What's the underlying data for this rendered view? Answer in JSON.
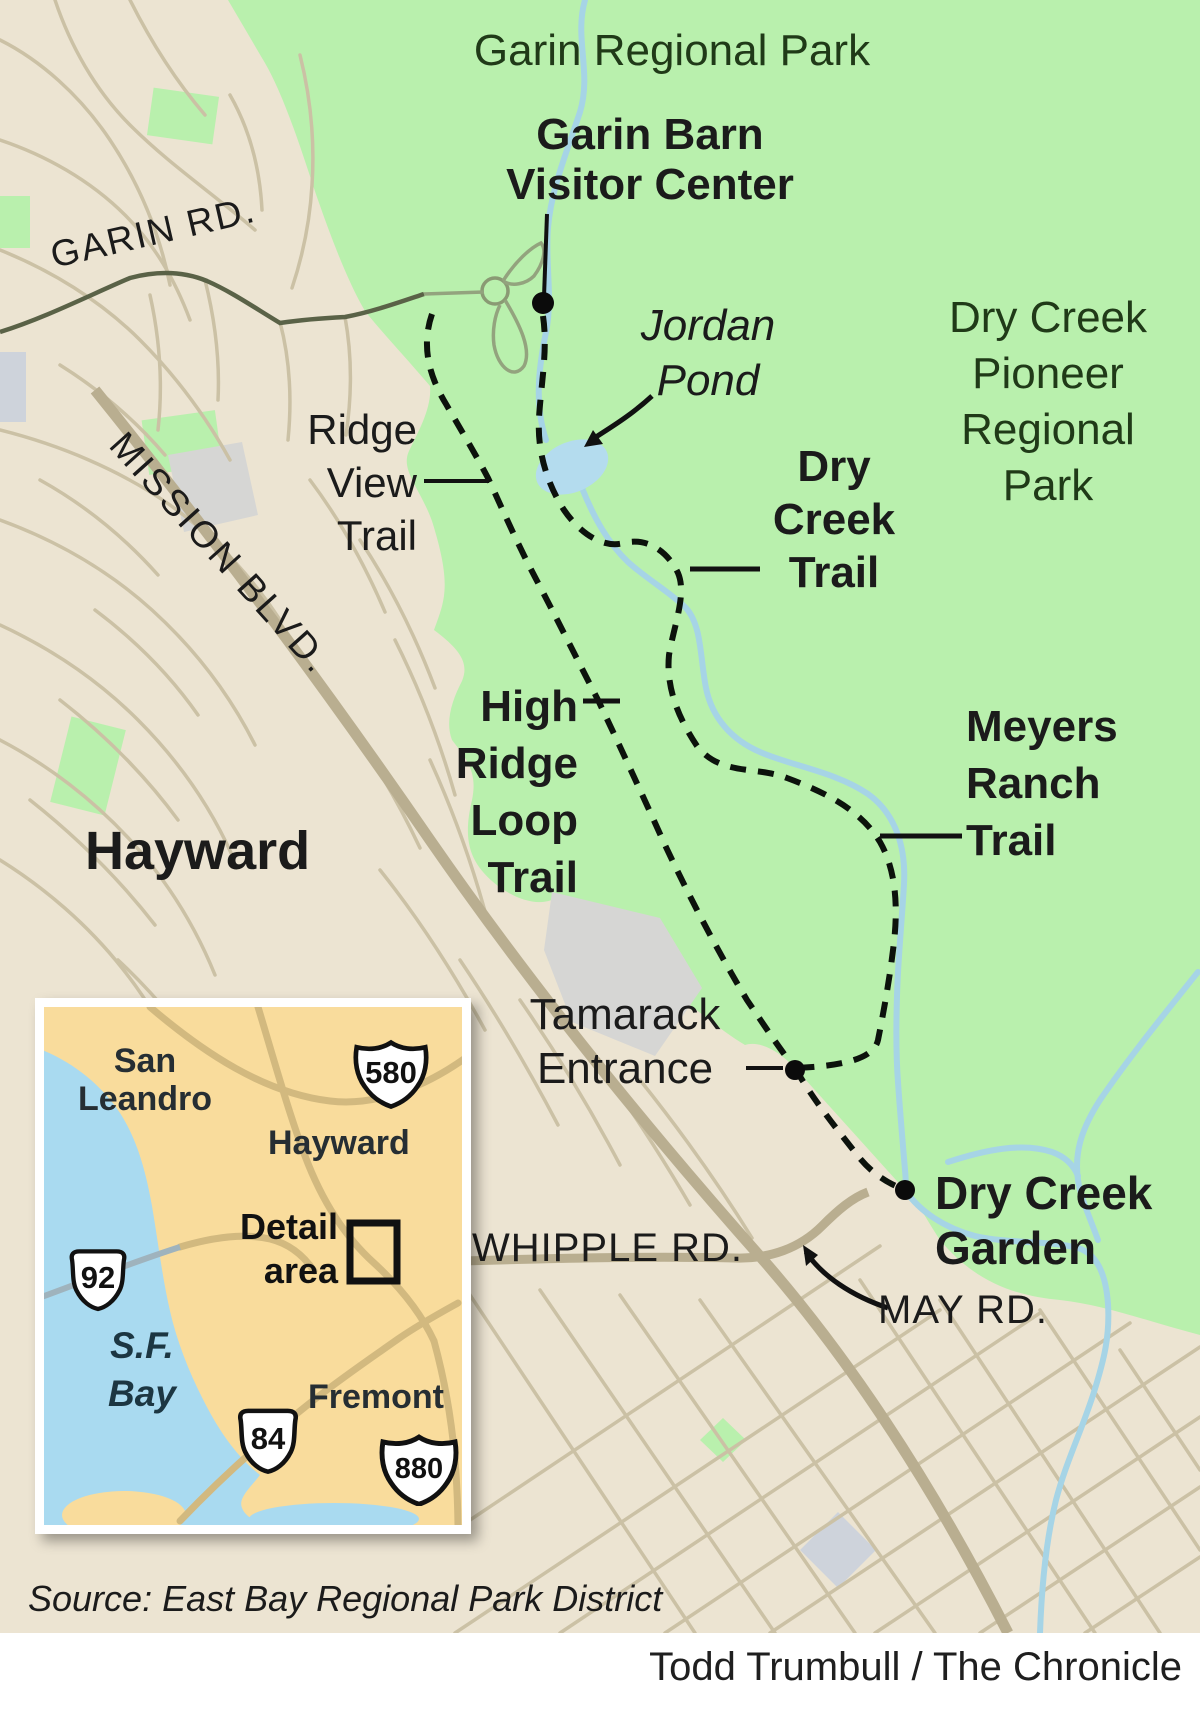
{
  "map": {
    "title": "Garin Regional Park",
    "park2_lines": [
      "Dry Creek",
      "Pioneer",
      "Regional",
      "Park"
    ],
    "city": "Hayward",
    "poi": {
      "visitor_center_lines": [
        "Garin Barn",
        "Visitor Center"
      ],
      "jordan_pond_lines": [
        "Jordan",
        "Pond"
      ],
      "tamarack_lines": [
        "Tamarack",
        "Entrance"
      ],
      "garden_lines": [
        "Dry Creek",
        "Garden"
      ]
    },
    "trails": {
      "ridge_view_lines": [
        "Ridge",
        "View",
        "Trail"
      ],
      "high_ridge_lines": [
        "High",
        "Ridge",
        "Loop",
        "Trail"
      ],
      "dry_creek_lines": [
        "Dry",
        "Creek",
        "Trail"
      ],
      "meyers_lines": [
        "Meyers",
        "Ranch",
        "Trail"
      ]
    },
    "roads": {
      "garin": "GARIN RD.",
      "mission": "MISSION BLVD.",
      "whipple": "WHIPPLE RD.",
      "may": "MAY RD."
    }
  },
  "inset": {
    "cities": {
      "san_leandro_lines": [
        "San",
        "Leandro"
      ],
      "hayward": "Hayward",
      "fremont": "Fremont"
    },
    "labels": {
      "detail_lines": [
        "Detail",
        "area"
      ],
      "sf_bay_lines": [
        "S.F.",
        "Bay"
      ]
    },
    "shields": {
      "i580": "580",
      "i880": "880",
      "ca92": "92",
      "ca84": "84"
    }
  },
  "footer": {
    "source": "Source: East Bay Regional Park District",
    "credit": "Todd Trumbull / The Chronicle"
  },
  "colors": {
    "park_green": "#b9f0ad",
    "urban_beige": "#ece4d2",
    "water_blue": "#a6d4e6",
    "pond_blue": "#b4dcee",
    "inset_bg": "#f9dc9c",
    "trail_black": "#0c120c",
    "road_major": "#b9ae90",
    "road_minor": "#cbc1a5",
    "road_garin": "#5a6247",
    "label_black": "#1b1b1b",
    "park_label_green": "#203a18"
  }
}
